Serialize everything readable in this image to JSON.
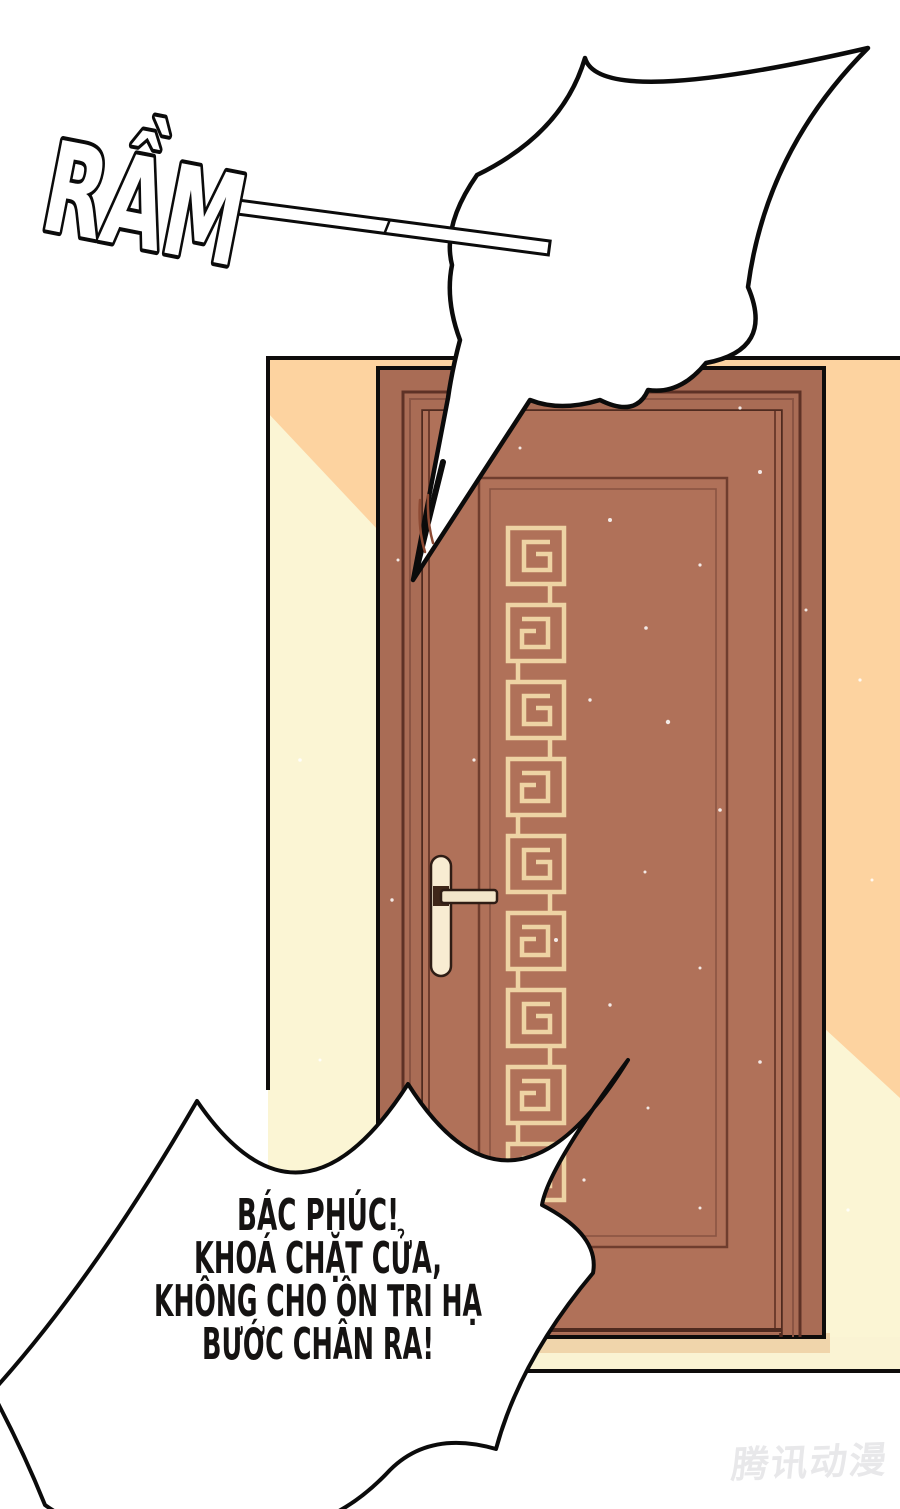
{
  "page": {
    "kind": "comic page panel",
    "width": 900,
    "height": 1509
  },
  "sfx": {
    "slam": "RẦM"
  },
  "impact_bubble": {
    "text": ""
  },
  "speech_bubble": {
    "lines": [
      "BÁC PHÚC!",
      "KHOÁ CHẶT CỬA,",
      "KHÔNG CHO ÔN TRI HẠ",
      "BƯỚC CHÂN RA!"
    ]
  },
  "watermark": {
    "text": "腾讯动漫"
  },
  "colors": {
    "wall": "#fdd3a0",
    "wall_light": "#fbf5d4",
    "door_frame": "#a96c55",
    "door_slab": "#b07159",
    "door_lines": "#6f3d2e",
    "meander": "#eed3a4",
    "floor": "#faf3d3",
    "floor_shadow": "#f0d5ab",
    "handle": "#f8ecd2",
    "outline": "#0e0c0b",
    "text": "#151312"
  }
}
